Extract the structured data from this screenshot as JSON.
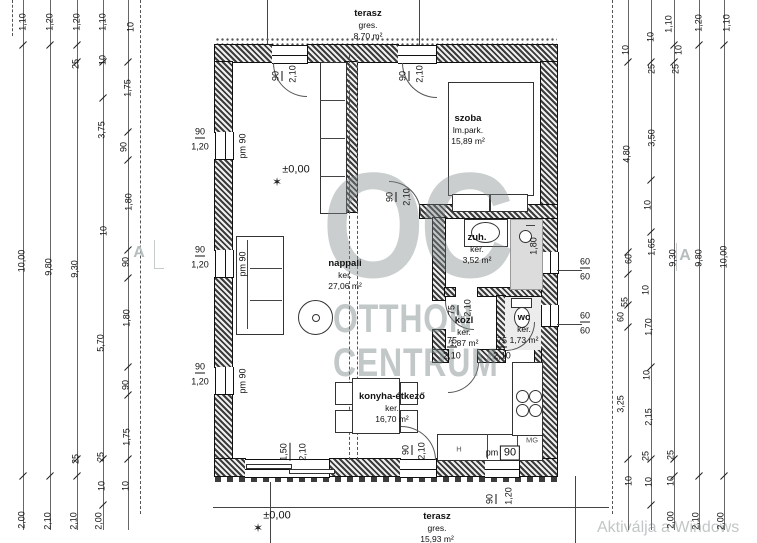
{
  "watermark": {
    "logo": "OC",
    "brand_top": "OTTHON",
    "brand_bottom": "CENTRUM",
    "activation_text": "Aktiválja a Windows"
  },
  "plan": {
    "rooms": [
      {
        "name": "terasz",
        "material": "gres.",
        "area": "8,70 m²",
        "cx": 368,
        "y": 8
      },
      {
        "name": "szoba",
        "material": "lm.park.",
        "area": "15,89 m²",
        "cx": 468,
        "y": 113
      },
      {
        "name": "nappali",
        "material": "ker.",
        "area": "27,06 m²",
        "cx": 345,
        "y": 258
      },
      {
        "name": "zuh.",
        "material": "ker.",
        "area": "3,52 m²",
        "cx": 477,
        "y": 232
      },
      {
        "name": "közl",
        "material": "ker.",
        "area": "1,87 m²",
        "cx": 464,
        "y": 315
      },
      {
        "name": "wc",
        "material": "ker.",
        "area": "1,73 m²",
        "cx": 524,
        "y": 312
      },
      {
        "name": "konyha-étkező",
        "material": "ker.",
        "area": "16,70 m²",
        "cx": 392,
        "y": 391
      },
      {
        "name": "terasz",
        "material": "gres.",
        "area": "15,93 m²",
        "cx": 437,
        "y": 511
      }
    ],
    "levels": [
      {
        "text": "±0,00",
        "x": 296,
        "y": 170
      },
      {
        "text": "±0,00",
        "x": 277,
        "y": 516
      }
    ],
    "level_marker_glyph": "✶",
    "section_markers": [
      {
        "text": "A",
        "x": 139,
        "y": 253
      },
      {
        "text": "A",
        "x": 685,
        "y": 256
      }
    ],
    "dim_left": [
      {
        "text": "1,10",
        "x": 23,
        "y": 22
      },
      {
        "text": "1,20",
        "x": 50,
        "y": 22
      },
      {
        "text": "1,20",
        "x": 77,
        "y": 22
      },
      {
        "text": "1,10",
        "x": 103,
        "y": 22
      },
      {
        "text": "10",
        "x": 131,
        "y": 27
      },
      {
        "text": "25",
        "x": 76,
        "y": 64
      },
      {
        "text": "10",
        "x": 103,
        "y": 60
      },
      {
        "text": "1,75",
        "x": 128,
        "y": 88
      },
      {
        "text": "3,75",
        "x": 102,
        "y": 130
      },
      {
        "text": "90",
        "x": 124,
        "y": 147
      },
      {
        "text": "1,80",
        "x": 129,
        "y": 202
      },
      {
        "text": "10",
        "x": 104,
        "y": 231
      },
      {
        "text": "10,00",
        "x": 22,
        "y": 261
      },
      {
        "text": "9,80",
        "x": 49,
        "y": 267
      },
      {
        "text": "9,30",
        "x": 75,
        "y": 269
      },
      {
        "text": "90",
        "x": 126,
        "y": 262
      },
      {
        "text": "1,80",
        "x": 127,
        "y": 318
      },
      {
        "text": "5,70",
        "x": 101,
        "y": 343
      },
      {
        "text": "90",
        "x": 126,
        "y": 385
      },
      {
        "text": "1,75",
        "x": 127,
        "y": 437
      },
      {
        "text": "25",
        "x": 76,
        "y": 459
      },
      {
        "text": "25",
        "x": 101,
        "y": 457
      },
      {
        "text": "10",
        "x": 102,
        "y": 486
      },
      {
        "text": "10",
        "x": 126,
        "y": 486
      },
      {
        "text": "2,00",
        "x": 22,
        "y": 520
      },
      {
        "text": "2,10",
        "x": 48,
        "y": 521
      },
      {
        "text": "2,10",
        "x": 74,
        "y": 521
      },
      {
        "text": "2,00",
        "x": 99,
        "y": 521
      }
    ],
    "dim_right": [
      {
        "text": "10",
        "x": 626,
        "y": 50
      },
      {
        "text": "10",
        "x": 651,
        "y": 37
      },
      {
        "text": "25",
        "x": 652,
        "y": 69
      },
      {
        "text": "10",
        "x": 679,
        "y": 50
      },
      {
        "text": "25",
        "x": 676,
        "y": 69
      },
      {
        "text": "1,10",
        "x": 669,
        "y": 24
      },
      {
        "text": "1,20",
        "x": 699,
        "y": 23
      },
      {
        "text": "1,10",
        "x": 727,
        "y": 23
      },
      {
        "text": "4,80",
        "x": 627,
        "y": 154
      },
      {
        "text": "3,50",
        "x": 652,
        "y": 138
      },
      {
        "text": "10",
        "x": 648,
        "y": 205
      },
      {
        "text": "1,65",
        "x": 652,
        "y": 247
      },
      {
        "text": "60",
        "x": 629,
        "y": 259
      },
      {
        "text": "10",
        "x": 646,
        "y": 290
      },
      {
        "text": "55",
        "x": 625,
        "y": 302
      },
      {
        "text": "60",
        "x": 621,
        "y": 317
      },
      {
        "text": "1,70",
        "x": 649,
        "y": 327
      },
      {
        "text": "9,30",
        "x": 673,
        "y": 258
      },
      {
        "text": "9,80",
        "x": 699,
        "y": 258
      },
      {
        "text": "10,00",
        "x": 724,
        "y": 257
      },
      {
        "text": "10",
        "x": 647,
        "y": 375
      },
      {
        "text": "3,25",
        "x": 621,
        "y": 404
      },
      {
        "text": "2,15",
        "x": 649,
        "y": 417
      },
      {
        "text": "25",
        "x": 646,
        "y": 456
      },
      {
        "text": "25",
        "x": 671,
        "y": 455
      },
      {
        "text": "10",
        "x": 629,
        "y": 481
      },
      {
        "text": "10",
        "x": 649,
        "y": 482
      },
      {
        "text": "10",
        "x": 671,
        "y": 481
      },
      {
        "text": "2,00",
        "x": 671,
        "y": 520
      },
      {
        "text": "2,10",
        "x": 696,
        "y": 521
      },
      {
        "text": "2,00",
        "x": 721,
        "y": 521
      }
    ],
    "opening_labels": [
      {
        "text": "90",
        "x": 277,
        "y": 76,
        "rot": 1,
        "bar": 1
      },
      {
        "text": "2,10",
        "x": 293,
        "y": 74,
        "rot": 1
      },
      {
        "text": "90",
        "x": 404,
        "y": 76,
        "rot": 1,
        "bar": 1
      },
      {
        "text": "2,10",
        "x": 420,
        "y": 74,
        "rot": 1
      },
      {
        "text": "90",
        "x": 391,
        "y": 197,
        "rot": 1,
        "bar": 1
      },
      {
        "text": "2,10",
        "x": 407,
        "y": 197,
        "rot": 1
      },
      {
        "text": "90",
        "x": 200,
        "y": 133,
        "bar": 1
      },
      {
        "text": "1,20",
        "x": 200,
        "y": 147
      },
      {
        "text": "pm 90",
        "x": 243,
        "y": 146,
        "rot": 1
      },
      {
        "text": "90",
        "x": 200,
        "y": 251,
        "bar": 1
      },
      {
        "text": "1,20",
        "x": 200,
        "y": 265
      },
      {
        "text": "pm 90",
        "x": 243,
        "y": 264,
        "rot": 1
      },
      {
        "text": "90",
        "x": 200,
        "y": 368,
        "bar": 1
      },
      {
        "text": "1,20",
        "x": 200,
        "y": 382
      },
      {
        "text": "pm 90",
        "x": 243,
        "y": 381,
        "rot": 1
      },
      {
        "text": "75",
        "x": 453,
        "y": 310,
        "rot": 1,
        "bar": 1
      },
      {
        "text": "2,10",
        "x": 468,
        "y": 308,
        "rot": 1
      },
      {
        "text": "75",
        "x": 452,
        "y": 342,
        "bar": 1
      },
      {
        "text": "2,10",
        "x": 452,
        "y": 356
      },
      {
        "text": "75",
        "x": 502,
        "y": 342,
        "bar": 1
      },
      {
        "text": "2,10",
        "x": 502,
        "y": 356
      },
      {
        "text": "1,80",
        "x": 534,
        "y": 246,
        "rot": 1
      },
      {
        "text": "60",
        "x": 585,
        "y": 263,
        "bar": 1
      },
      {
        "text": "60",
        "x": 585,
        "y": 277
      },
      {
        "text": "60",
        "x": 585,
        "y": 317,
        "bar": 1
      },
      {
        "text": "60",
        "x": 585,
        "y": 331
      },
      {
        "text": "1,50",
        "x": 285,
        "y": 452,
        "rot": 1,
        "bar": 1
      },
      {
        "text": "2,10",
        "x": 303,
        "y": 452,
        "rot": 1
      },
      {
        "text": "90",
        "x": 407,
        "y": 450,
        "rot": 1,
        "bar": 1
      },
      {
        "text": "2,10",
        "x": 422,
        "y": 451,
        "rot": 1
      },
      {
        "text": "90",
        "x": 491,
        "y": 499,
        "rot": 1,
        "bar": 1
      },
      {
        "text": "1,20",
        "x": 509,
        "y": 496,
        "rot": 1
      },
      {
        "text": "pm",
        "x": 492,
        "y": 453
      },
      {
        "text": "90",
        "x": 510,
        "y": 453,
        "box": 1
      }
    ],
    "appliance_labels": [
      {
        "text": "H",
        "x": 459,
        "y": 449
      },
      {
        "text": "MG",
        "x": 532,
        "y": 440
      }
    ]
  }
}
